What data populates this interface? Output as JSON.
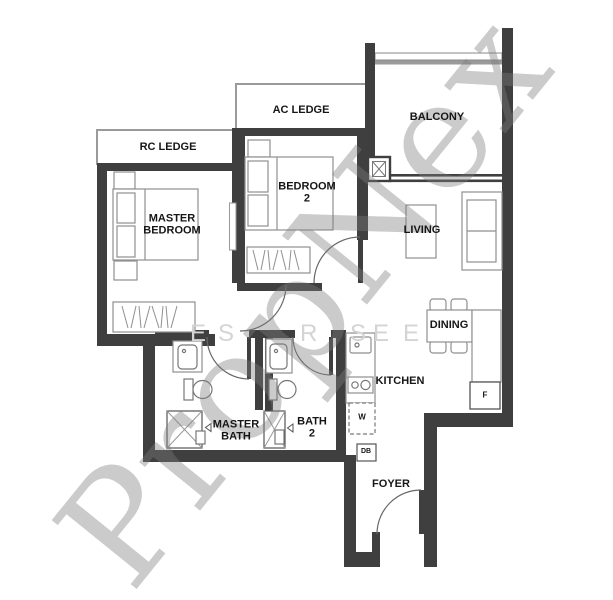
{
  "watermark": {
    "brand": "PropNex",
    "letters": [
      "E",
      "S",
      "R",
      "S",
      "E",
      "E"
    ]
  },
  "rooms": {
    "rc_ledge": "RC LEDGE",
    "ac_ledge": "AC LEDGE",
    "balcony": "BALCONY",
    "master_bedroom": [
      "MASTER",
      "BEDROOM"
    ],
    "bedroom_2": [
      "BEDROOM",
      "2"
    ],
    "living": "LIVING",
    "dining": "DINING",
    "kitchen": "KITCHEN",
    "master_bath": [
      "MASTER",
      "BATH"
    ],
    "bath_2": [
      "BATH",
      "2"
    ],
    "foyer": "FOYER"
  },
  "appliances": {
    "washer": "W",
    "distribution_board": "DB",
    "fridge": "F"
  },
  "colors": {
    "wall": "#3f3f3f",
    "furniture_stroke": "#8f8f8f",
    "watermark": "#bdbdbd",
    "background": "#ffffff"
  }
}
